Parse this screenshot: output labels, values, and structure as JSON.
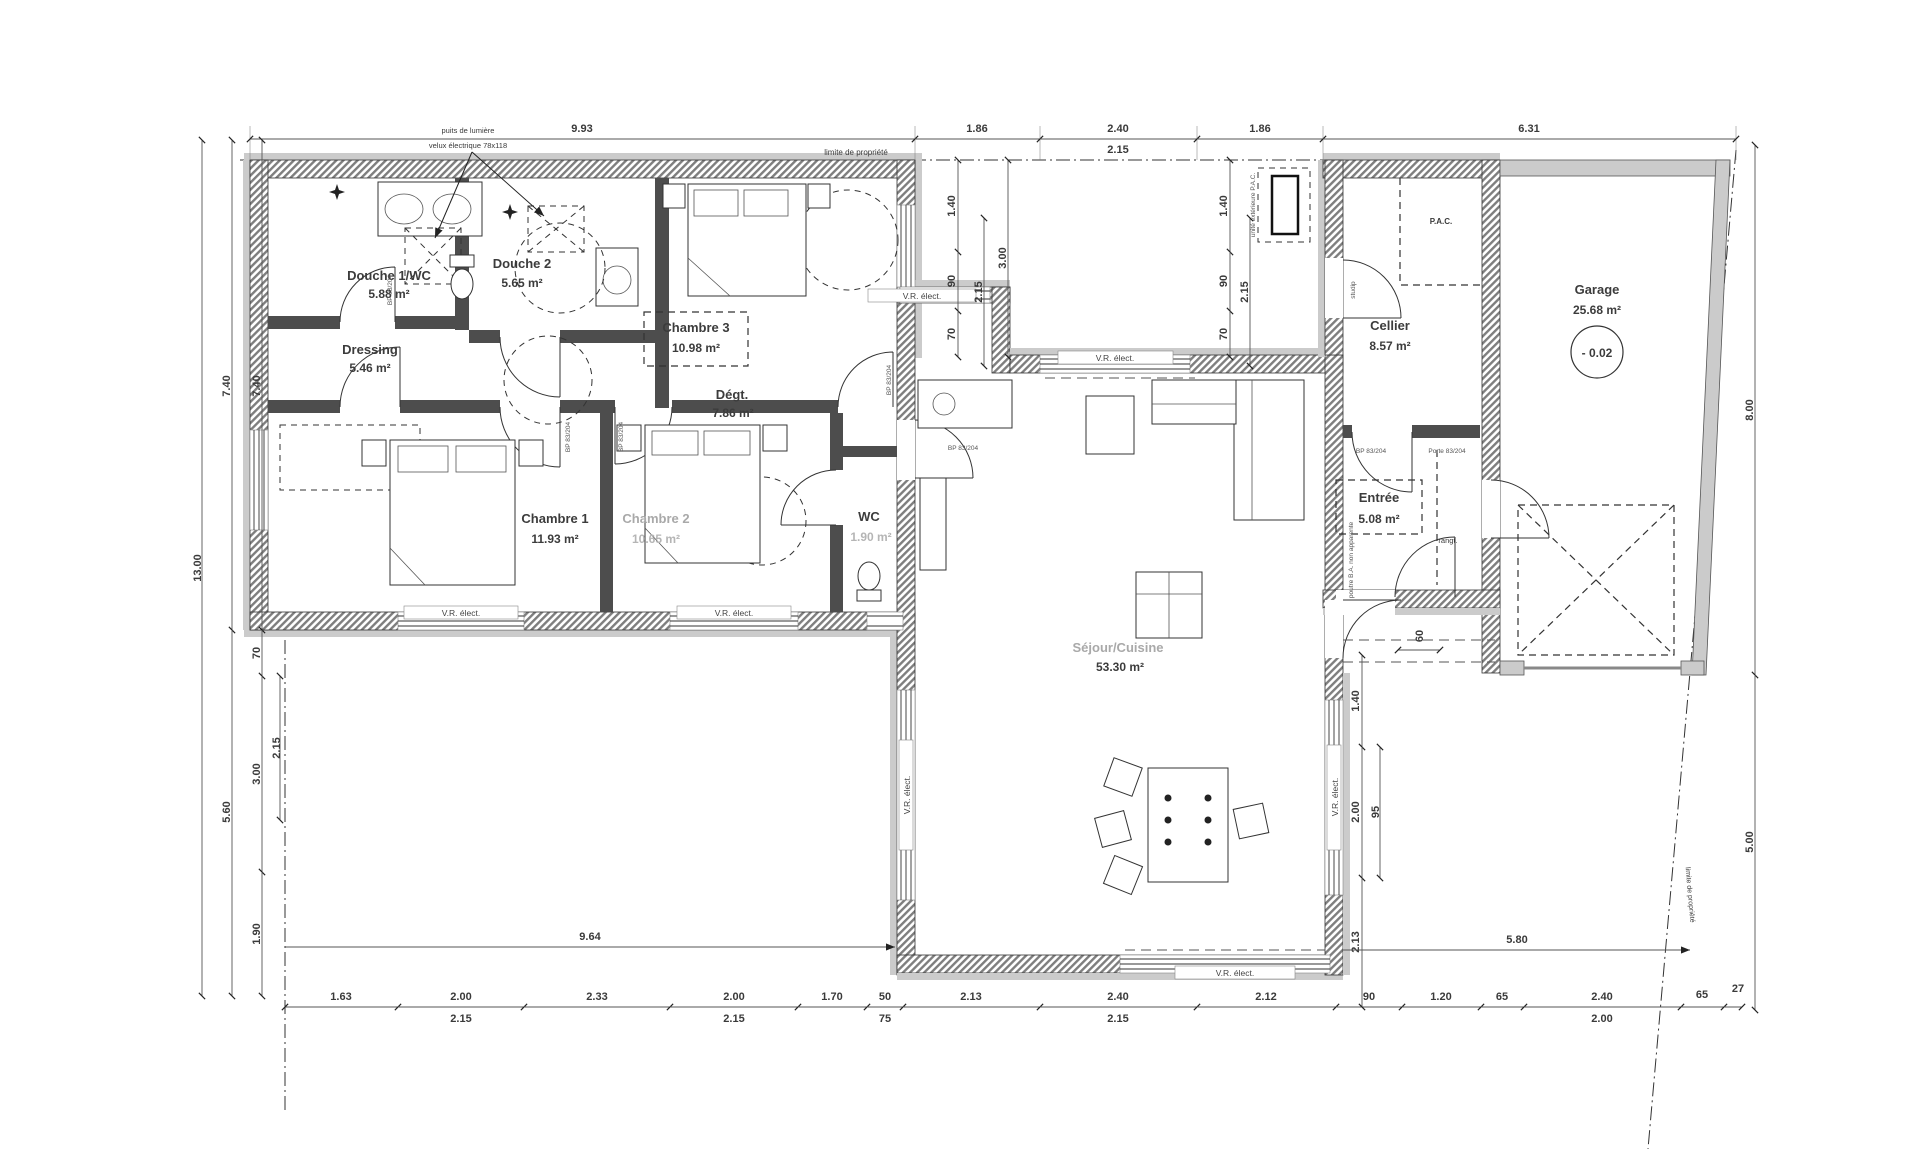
{
  "annotations": {
    "puits": "puits de lumière",
    "velux": "velux électrique 78x118",
    "limite": "limite de propriété",
    "vr": "V.R. élect.",
    "pac_ext": "unité extérieure P.A.C.",
    "poutre": "poutre B.A. non apparente",
    "rangt": "rangt.",
    "level": "- 0.02",
    "door_tag": "studip",
    "ref_bp": "BP 83/204",
    "ref_porte": "Porte 83/204"
  },
  "rooms": [
    {
      "name": "Douche 1/WC",
      "area": "5.88 m²"
    },
    {
      "name": "Douche 2",
      "area": "5.65 m²"
    },
    {
      "name": "Dressing",
      "area": "5.46 m²"
    },
    {
      "name": "Chambre 3",
      "area": "10.98 m²"
    },
    {
      "name": "Dégt.",
      "area": "7.86 m²"
    },
    {
      "name": "Chambre 1",
      "area": "11.93 m²"
    },
    {
      "name": "Chambre 2",
      "area": "10.65 m²"
    },
    {
      "name": "WC",
      "area": "1.90 m²"
    },
    {
      "name": "Séjour/Cuisine",
      "area": "53.30 m²"
    },
    {
      "name": "Cellier",
      "area": "8.57 m²"
    },
    {
      "name": "P.A.C.",
      "area": ""
    },
    {
      "name": "Entrée",
      "area": "5.08 m²"
    },
    {
      "name": "Garage",
      "area": "25.68 m²"
    }
  ],
  "dims": {
    "top": [
      "9.93",
      "1.86",
      "2.40",
      "1.86",
      "6.31"
    ],
    "top_sub": "2.15",
    "left_total": "13.00",
    "left_upper": [
      "7.40",
      "7.40"
    ],
    "left_lower": [
      "70",
      "3.00",
      "2.15",
      "5.60",
      "1.90"
    ],
    "right": [
      "8.00",
      "5.00"
    ],
    "bottom": [
      "1.63",
      "2.00",
      "2.33",
      "2.00",
      "1.70",
      "50",
      "2.13",
      "2.40",
      "2.12",
      "90",
      "1.20",
      "65",
      "2.40",
      "65",
      "27"
    ],
    "bottom_sub": [
      "2.15",
      "2.15",
      "75",
      "2.15",
      "2.00"
    ],
    "patio_left": [
      "1.40",
      "90",
      "70",
      "2.15",
      "3.00"
    ],
    "patio_right": [
      "1.40",
      "90",
      "70",
      "2.15"
    ],
    "east": [
      "60",
      "1.40",
      "2.00",
      "95",
      "2.13"
    ],
    "mid": [
      "9.64",
      "5.80"
    ]
  }
}
